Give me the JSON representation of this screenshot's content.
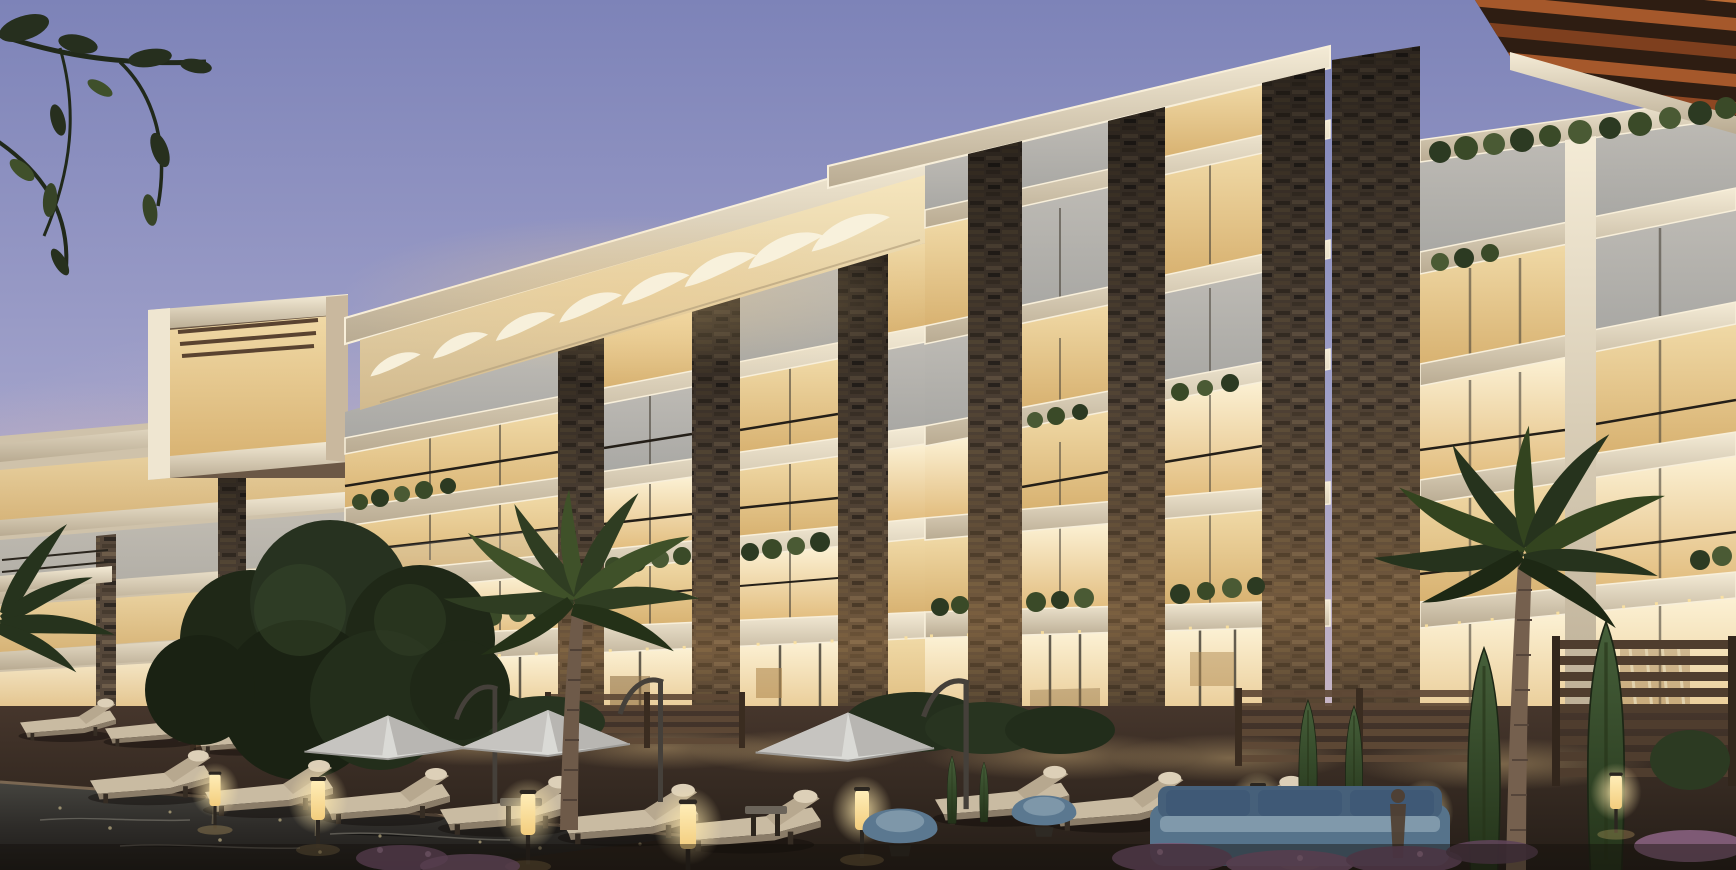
{
  "image": {
    "title": "Twilight architectural rendering of a modern luxury apartment complex with illuminated balconies, a sail-shaded roof canopy, timber pergola, and a pool deck with sun loungers, parasols and palm trees",
    "type": "architectural exterior rendering",
    "time_of_day": "dusk",
    "visible_text": "none"
  },
  "palette": {
    "sky_top": "#7d83b8",
    "sky_mid": "#9fa0c9",
    "sky_low": "#c3b3c6",
    "horizon_pink": "#e0c2bd",
    "facade_cream": "#e9dec6",
    "facade_shadow": "#b9ab92",
    "slab_bright": "#f4ebd6",
    "stone_dark": "#3a3128",
    "stone_mid": "#55473a",
    "stone_light": "#7b6953",
    "window_warm": "#f0d9a6",
    "window_bright": "#fcf1d4",
    "window_amber": "#e2bd7e",
    "glass_cool": "#a9a8a4",
    "canopy_warm": "#edd9ad",
    "sail_white": "#f8f1de",
    "pergola_wood": "#a5582b",
    "pergola_dark": "#7e3f1e",
    "foliage_dark": "#222b18",
    "foliage_mid": "#3a4a28",
    "foliage_light": "#5a6e3c",
    "palm_green": "#2f3d22",
    "deck_brown": "#46362c",
    "deck_dark": "#241d17",
    "pool_dark": "#2e2c29",
    "umbrella_white": "#dadad6",
    "cushion_beige": "#c9bba2",
    "frame_dark": "#352c23",
    "lamp_glow": "#f6d890",
    "seating_blue": "#5b7890",
    "cushion_blue": "#7e97a9",
    "flower_purple": "#7a5573"
  },
  "scene": {
    "setting": "residential compound pool courtyard at dusk",
    "building": {
      "wings": 3,
      "floors_visible": 5,
      "materials": [
        "cream concrete slabs",
        "stacked dark stone piers",
        "floor-to-ceiling glazing",
        "glass balustrades",
        "balcony planters"
      ]
    },
    "roof_features": [
      "white sail shade canopy over mid wing",
      "orange-brown timber slat pergola on right tower"
    ],
    "counts": {
      "parasols": 3,
      "sun_loungers": 13,
      "path_lights": 9,
      "palm_trees": 3,
      "cypress_trees": 6,
      "stone_piers": 8
    },
    "ground_features": [
      "dark reflecting pool",
      "timber deck",
      "hedges",
      "slatted wood fences",
      "purple flower beds",
      "blue rattan lounge set",
      "side tables",
      "single person silhouette"
    ]
  }
}
